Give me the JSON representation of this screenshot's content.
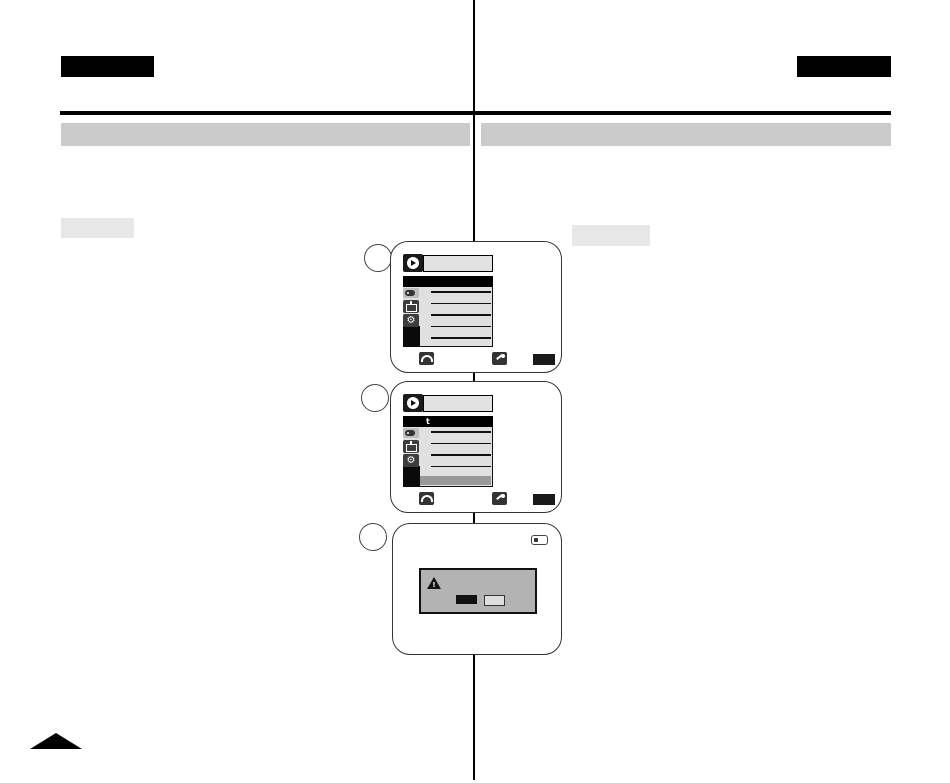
{
  "document": {
    "kind": "camcorder user-manual page scan, text redacted",
    "language_tab_left": "",
    "language_tab_right": "",
    "section_bar_left": "",
    "section_bar_right": "",
    "inline_label_left": "",
    "inline_label_right": "",
    "page_corner_marker": "black-triangle"
  },
  "steps": [
    {
      "number": "",
      "screen": "menu-list-screen"
    },
    {
      "number": "",
      "screen": "menu-submenu-screen"
    },
    {
      "number": "",
      "screen": "warning-dialog-screen"
    }
  ],
  "glyphs": {
    "gear": "⚙",
    "warning_mark": "!",
    "menu_return_mark": "t"
  },
  "screens": [
    {
      "name": "menu-list-screen",
      "mode_icon": "play-mode-icon",
      "title_bar_text": "",
      "selected_row_text": "",
      "sidebar_icons": [
        "tape-card-icon",
        "tv-display-icon",
        "settings-gear-icon"
      ],
      "menu_placeholder_lines": 5,
      "footer_controls": [
        "jog-dial-icon",
        "joystick-icon",
        "menu-button"
      ]
    },
    {
      "name": "menu-submenu-screen",
      "mode_icon": "play-mode-icon",
      "title_bar_text": "",
      "selected_row_text": "",
      "sidebar_icons": [
        "tape-card-icon",
        "tv-display-icon",
        "settings-gear-icon"
      ],
      "menu_placeholder_lines": 4,
      "has_bottom_highlight_bar": true,
      "footer_controls": [
        "jog-dial-icon",
        "joystick-icon",
        "menu-button"
      ]
    },
    {
      "name": "warning-dialog-screen",
      "status_icons": [
        "battery-icon"
      ],
      "dialog": {
        "icon": "warning-triangle-icon",
        "message_text": "",
        "buttons": [
          {
            "name": "dark-button",
            "label": ""
          },
          {
            "name": "light-button",
            "label": ""
          }
        ]
      }
    }
  ],
  "colors": {
    "page_background": "#ffffff",
    "ink": "#000000",
    "section_bar": "#cbcbcb",
    "inline_label_box": "#e7e7e7",
    "lcd_menu_background": "#e0e0e0",
    "lcd_footer_highlight": "#999999",
    "dialog_background": "#b3b3b3",
    "icon_box": "#3d3d3d"
  }
}
